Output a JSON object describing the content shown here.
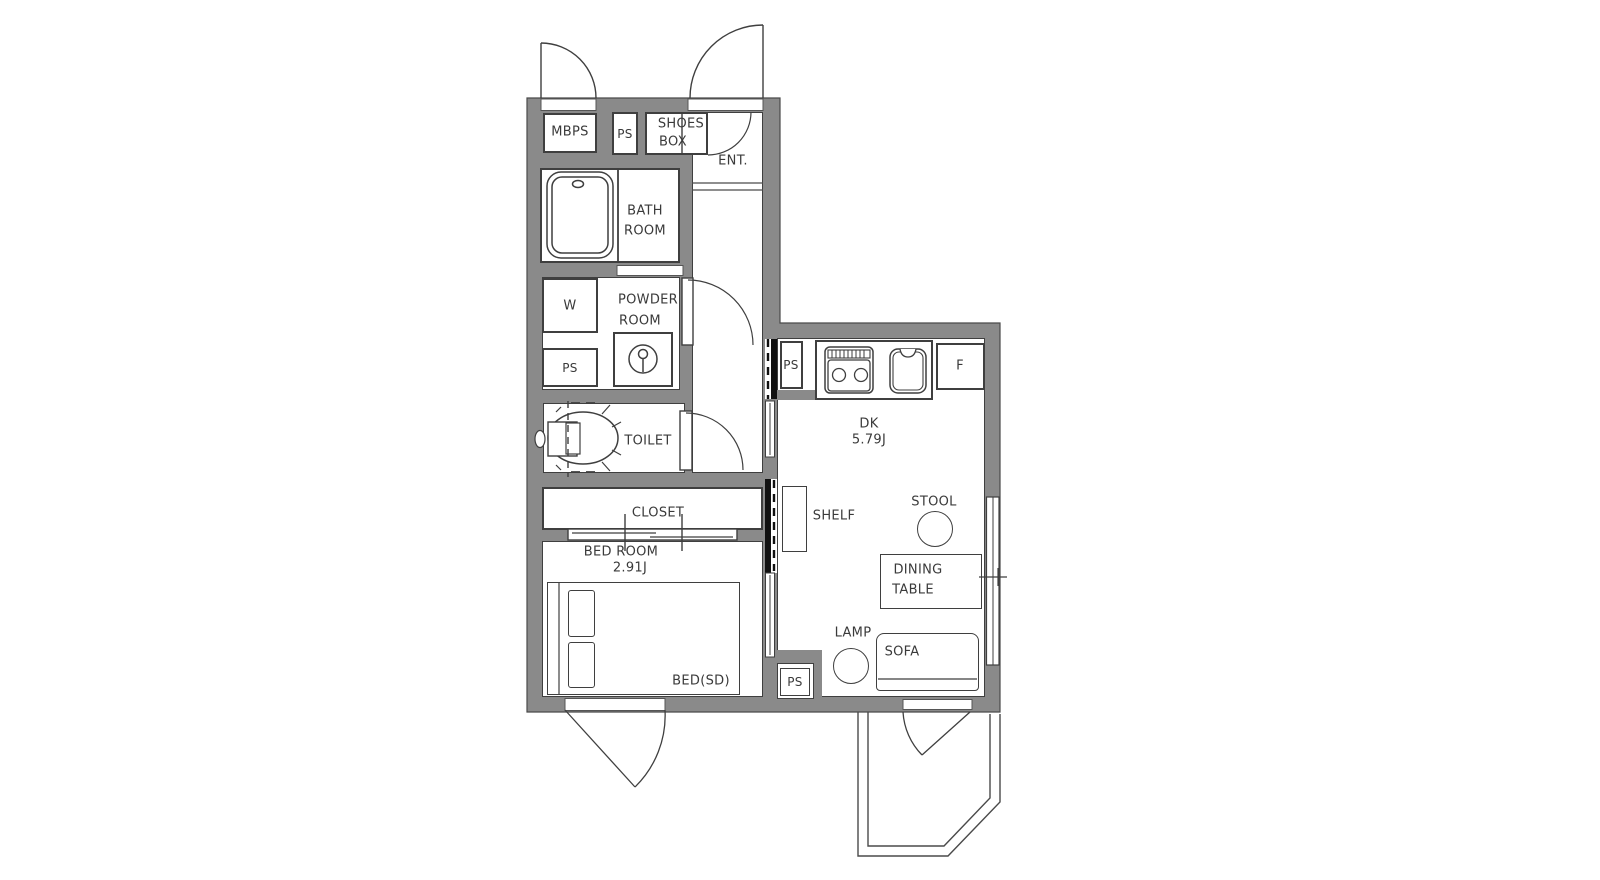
{
  "floorplan": {
    "rooms": {
      "mbps": "MBPS",
      "ps": "PS",
      "shoes_box": [
        "SHOES",
        "BOX"
      ],
      "entrance": "ENT.",
      "bathroom": [
        "BATH",
        "ROOM"
      ],
      "washer": "W",
      "powder_room": [
        "POWDER",
        "ROOM"
      ],
      "toilet": "TOILET",
      "closet": "CLOSET",
      "bedroom": {
        "name": "BED ROOM",
        "size": "2.91J"
      },
      "bed": "BED(SD)",
      "dk": {
        "name": "DK",
        "size": "5.79J"
      },
      "fridge": "F",
      "shelf": "SHELF",
      "stool": "STOOL",
      "dining_table": [
        "DINING",
        "TABLE"
      ],
      "lamp": "LAMP",
      "sofa": "SOFA"
    },
    "colors": {
      "wall": "#8a8a8a",
      "outline": "#3f3f3f",
      "black_fill": "#111111",
      "background": "#ffffff"
    }
  }
}
